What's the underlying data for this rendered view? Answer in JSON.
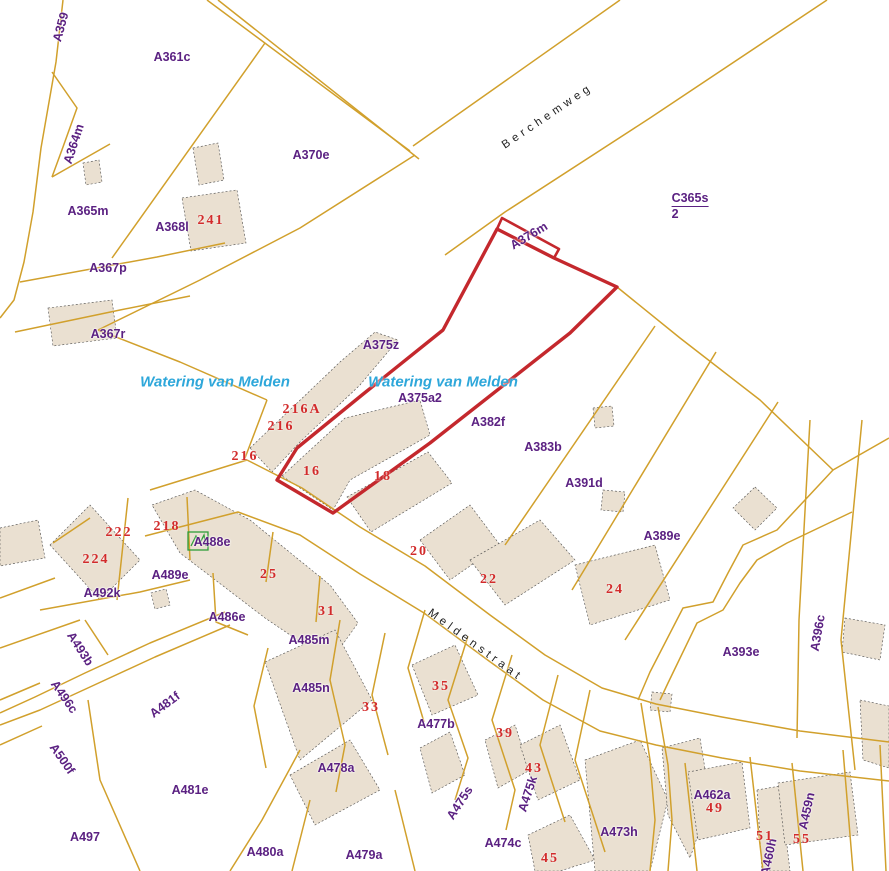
{
  "map": {
    "type": "cadastral-parcel-map",
    "streets": {
      "berchemweg": "Berchemweg",
      "meldenstraat": "Meldenstraat"
    },
    "water": {
      "text": "Watering van Melden"
    },
    "fraction": {
      "numerator": "C365s",
      "denominator": "2"
    },
    "selected_parcel": {
      "id": "A376m",
      "outline_color": "#c4282d"
    },
    "parcels": {
      "a359": "A359",
      "a361c": "A361c",
      "a364m": "A364m",
      "a365m": "A365m",
      "a368l": "A368l",
      "a367p": "A367p",
      "a367r": "A367r",
      "a370e": "A370e",
      "a376m": "A376m",
      "a375z": "A375z",
      "a375a2": "A375a2",
      "a382f": "A382f",
      "a383b": "A383b",
      "a391d": "A391d",
      "a389e": "A389e",
      "a393e": "A393e",
      "a396c": "A396c",
      "a492k": "A492k",
      "a489e": "A489e",
      "a488e": "A488e",
      "a486e": "A486e",
      "a485m": "A485m",
      "a493b": "A493b",
      "a496c": "A496c",
      "a481f": "A481f",
      "a500f": "A500f",
      "a497": "A497",
      "a481e": "A481e",
      "a480a": "A480a",
      "a479a": "A479a",
      "a478a": "A478a",
      "a485n": "A485n",
      "a477b": "A477b",
      "a475s": "A475s",
      "a475k": "A475k",
      "a474c": "A474c",
      "a473h": "A473h",
      "a462a": "A462a",
      "a459n": "A459n",
      "a460h": "A460h"
    },
    "house_numbers": {
      "n241": "241",
      "n216a": "216A",
      "n216_1": "216",
      "n216_2": "216",
      "n16": "16",
      "n18": "18",
      "n20": "20",
      "n22": "22",
      "n24": "24",
      "n25": "25",
      "n31": "31",
      "n33": "33",
      "n35": "35",
      "n39": "39",
      "n43": "43",
      "n45": "45",
      "n49": "49",
      "n51": "51",
      "n55": "55",
      "n218": "218",
      "n222": "222",
      "n224": "224"
    },
    "colors": {
      "parcel_line": "#d1a02c",
      "building_fill": "#eae0d1",
      "building_outline": "#4a4a4a",
      "selected_outline": "#c4282d",
      "parcel_label": "#5b2182",
      "house_number": "#d22b2b",
      "water_label": "#2ea7da",
      "street_label": "#1f1f1f",
      "poi_symbol": "#2e9e3a"
    }
  }
}
